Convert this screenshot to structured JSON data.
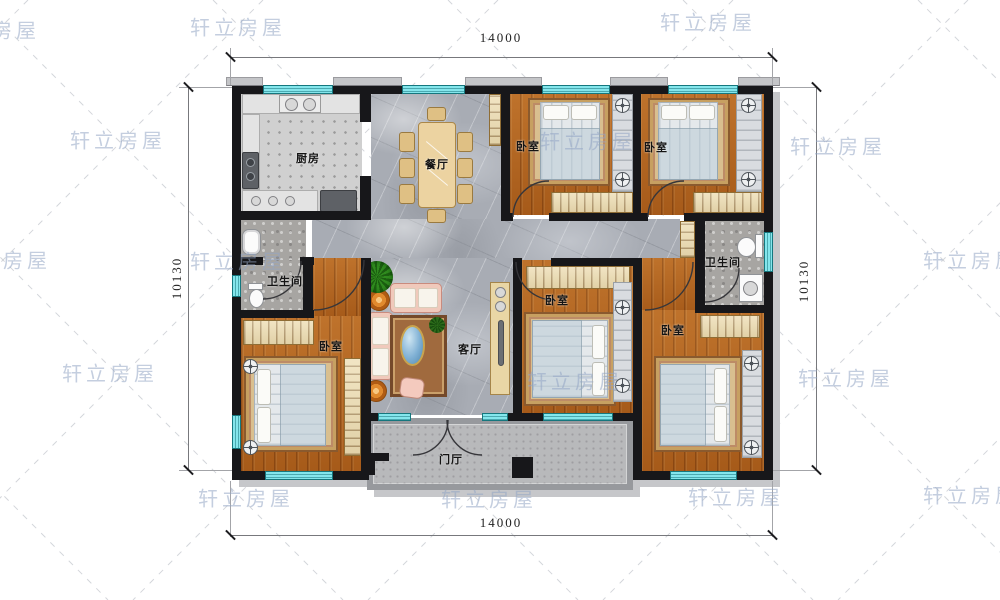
{
  "watermark": {
    "text": "轩立房屋"
  },
  "dimensions": {
    "top": "14000",
    "bottom": "14000",
    "left": "10130",
    "right": "10130"
  },
  "rooms": {
    "kitchen": {
      "label": "厨房"
    },
    "dining": {
      "label": "餐厅"
    },
    "living": {
      "label": "客厅"
    },
    "foyer": {
      "label": "门厅"
    },
    "bath_left": {
      "label": "卫生间"
    },
    "bath_right": {
      "label": "卫生间"
    },
    "bedroom_top_middle": {
      "label": "卧室"
    },
    "bedroom_top_right": {
      "label": "卧室"
    },
    "bedroom_left": {
      "label": "卧室"
    },
    "bedroom_middle": {
      "label": "卧室"
    },
    "bedroom_bottom_right": {
      "label": "卧室"
    }
  },
  "colors": {
    "wall": "#17171a",
    "window": "#84e6ec",
    "wood_floor": "#b2641f",
    "marble_floor": "#a8acb4",
    "closet": "#eddcb0",
    "porch": "#b8b9bb",
    "watermark": "#94a6c4"
  }
}
